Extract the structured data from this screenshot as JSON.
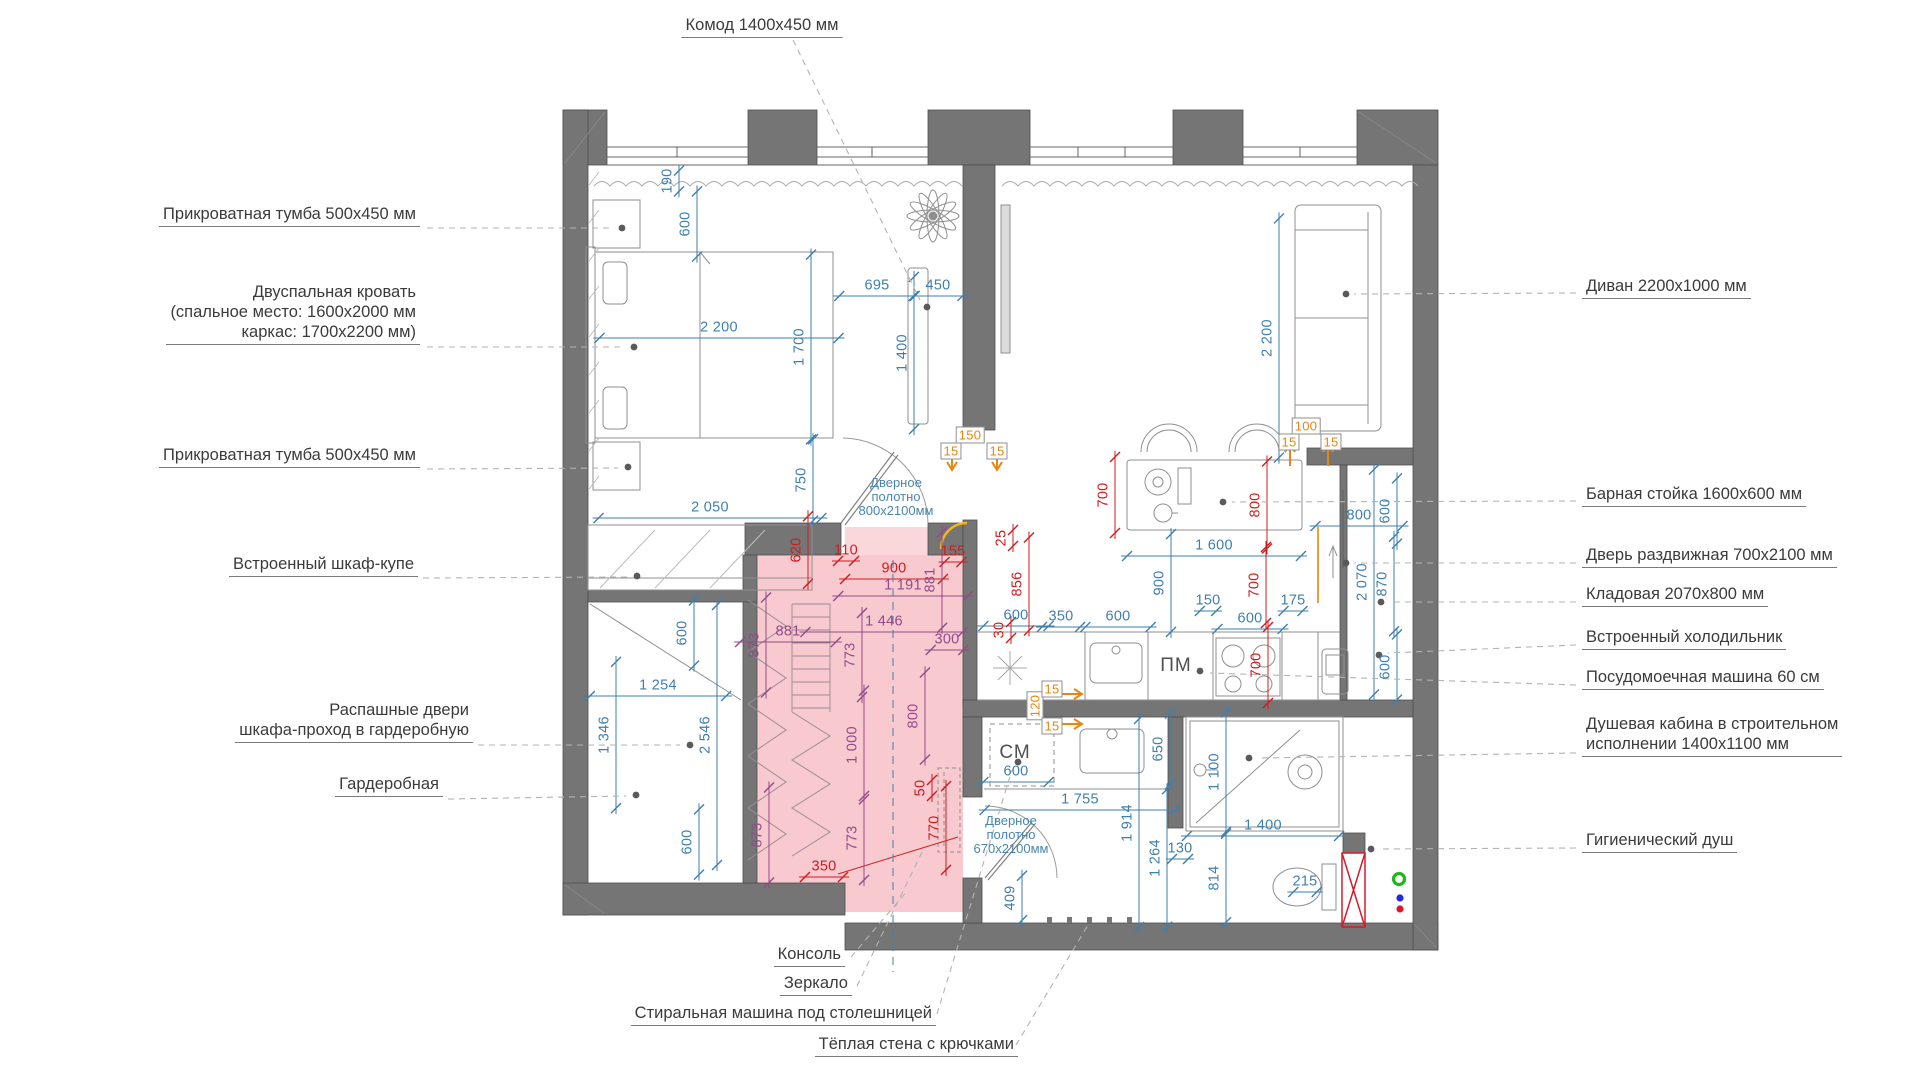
{
  "canvas": {
    "w": 1919,
    "h": 1079
  },
  "colors": {
    "wall": "#757575",
    "wall_edge": "#4e4e4e",
    "dim_blue": "#3f7fae",
    "dim_red": "#cf1d1d",
    "dim_purple": "#924a8a",
    "dim_orange": "#e8860d",
    "pink_zone": "#f8c9cf",
    "leader": "#b3b3b3",
    "furniture": "#8f8f8f",
    "accent_yellow": "#f3b51e",
    "marker_green": "#1db81d",
    "marker_blue": "#2525dd",
    "marker_red": "#e0152d"
  },
  "callouts": [
    {
      "name": "komod",
      "side": "top",
      "x": 762,
      "y": 26,
      "lines": [
        "Комод 1400х450 мм"
      ]
    },
    {
      "name": "nightstand-1",
      "side": "left",
      "x": 420,
      "y": 215,
      "lines": [
        "Прикроватная тумба  500х450 мм"
      ]
    },
    {
      "name": "bed",
      "side": "left",
      "x": 420,
      "y": 313,
      "lines": [
        "Двуспальная кровать",
        "(спальное место: 1600х2000 мм",
        "каркас: 1700х2200 мм)"
      ]
    },
    {
      "name": "nightstand-2",
      "side": "left",
      "x": 420,
      "y": 456,
      "lines": [
        "Прикроватная тумба  500х450 мм"
      ]
    },
    {
      "name": "built-in-wardrobe",
      "side": "left",
      "x": 418,
      "y": 565,
      "lines": [
        "Встроенный шкаф-купе"
      ]
    },
    {
      "name": "swing-doors",
      "side": "left",
      "x": 473,
      "y": 721,
      "lines": [
        "Распашные двери",
        "шкафа-проход в гардеробную"
      ]
    },
    {
      "name": "garderobnaya",
      "side": "left",
      "x": 443,
      "y": 785,
      "lines": [
        "Гардеробная"
      ]
    },
    {
      "name": "sofa",
      "side": "right",
      "x": 1582,
      "y": 287,
      "lines": [
        "Диван 2200х1000 мм"
      ]
    },
    {
      "name": "bar-counter",
      "side": "right",
      "x": 1582,
      "y": 495,
      "lines": [
        "Барная стойка 1600х600 мм"
      ]
    },
    {
      "name": "sliding-door",
      "side": "right",
      "x": 1582,
      "y": 556,
      "lines": [
        "Дверь раздвижная 700х2100 мм"
      ]
    },
    {
      "name": "kladovaya",
      "side": "right",
      "x": 1582,
      "y": 595,
      "lines": [
        "Кладовая 2070х800 мм"
      ]
    },
    {
      "name": "fridge",
      "side": "right",
      "x": 1582,
      "y": 638,
      "lines": [
        "Встроенный холодильник"
      ]
    },
    {
      "name": "dishwasher",
      "side": "right",
      "x": 1582,
      "y": 678,
      "lines": [
        "Посудомоечная машина 60 см"
      ]
    },
    {
      "name": "shower-cabin",
      "side": "right",
      "x": 1582,
      "y": 735,
      "lines": [
        "Душевая кабина в строительном",
        "исполнении 1400х1100 мм"
      ]
    },
    {
      "name": "hygienic-shower",
      "side": "right",
      "x": 1582,
      "y": 841,
      "lines": [
        "Гигиенический душ"
      ]
    },
    {
      "name": "console",
      "side": "bottom",
      "x": 845,
      "y": 955,
      "lines": [
        "Консоль"
      ]
    },
    {
      "name": "mirror",
      "side": "bottom",
      "x": 852,
      "y": 984,
      "lines": [
        "Зеркало"
      ]
    },
    {
      "name": "washing-machine",
      "side": "bottom",
      "x": 936,
      "y": 1014,
      "lines": [
        "Стиральная машина под столешницей"
      ]
    },
    {
      "name": "warm-wall",
      "side": "bottom",
      "x": 1018,
      "y": 1045,
      "lines": [
        "Тёплая стена с крючками"
      ]
    }
  ],
  "door_notes": [
    {
      "name": "door-leaf-800",
      "x": 896,
      "y": 476,
      "lines": [
        "Дверное",
        "полотно",
        "800х2100мм"
      ]
    },
    {
      "name": "door-leaf-670",
      "x": 1011,
      "y": 814,
      "lines": [
        "Дверное",
        "полотно",
        "670х2100мм"
      ]
    }
  ],
  "room_codes": [
    {
      "name": "dishwasher-code",
      "text": "ПМ",
      "x": 1176,
      "y": 666
    },
    {
      "name": "washer-code",
      "text": "СМ",
      "x": 1015,
      "y": 753
    }
  ],
  "dimensions": [
    {
      "t": "190",
      "x": 668,
      "y": 181,
      "r": 1,
      "c": "b"
    },
    {
      "t": "600",
      "x": 686,
      "y": 224,
      "r": 1,
      "c": "b"
    },
    {
      "t": "2 200",
      "x": 719,
      "y": 328,
      "c": "b"
    },
    {
      "t": "1 700",
      "x": 800,
      "y": 347,
      "r": 1,
      "c": "b"
    },
    {
      "t": "695",
      "x": 877,
      "y": 286,
      "c": "b"
    },
    {
      "t": "450",
      "x": 938,
      "y": 286,
      "c": "b"
    },
    {
      "t": "1 400",
      "x": 903,
      "y": 353,
      "r": 1,
      "c": "b"
    },
    {
      "t": "2 200",
      "x": 1268,
      "y": 338,
      "r": 1,
      "c": "b"
    },
    {
      "t": "2 050",
      "x": 710,
      "y": 508,
      "c": "b"
    },
    {
      "t": "750",
      "x": 802,
      "y": 480,
      "r": 1,
      "c": "b"
    },
    {
      "t": "600",
      "x": 683,
      "y": 633,
      "r": 1,
      "c": "b"
    },
    {
      "t": "1 254",
      "x": 658,
      "y": 686,
      "c": "b"
    },
    {
      "t": "1 346",
      "x": 605,
      "y": 735,
      "r": 1,
      "c": "b"
    },
    {
      "t": "2 546",
      "x": 706,
      "y": 735,
      "r": 1,
      "c": "b"
    },
    {
      "t": "600",
      "x": 688,
      "y": 842,
      "r": 1,
      "c": "b"
    },
    {
      "t": "600",
      "x": 1016,
      "y": 616,
      "c": "b"
    },
    {
      "t": "350",
      "x": 1061,
      "y": 617,
      "c": "b"
    },
    {
      "t": "600",
      "x": 1118,
      "y": 617,
      "c": "b"
    },
    {
      "t": "900",
      "x": 1160,
      "y": 583,
      "r": 1,
      "c": "b"
    },
    {
      "t": "150",
      "x": 1208,
      "y": 601,
      "c": "b"
    },
    {
      "t": "600",
      "x": 1250,
      "y": 619,
      "c": "b"
    },
    {
      "t": "175",
      "x": 1293,
      "y": 601,
      "c": "b"
    },
    {
      "t": "1 600",
      "x": 1214,
      "y": 546,
      "c": "b"
    },
    {
      "t": "800",
      "x": 1359,
      "y": 516,
      "c": "b"
    },
    {
      "t": "600",
      "x": 1386,
      "y": 511,
      "r": 1,
      "c": "b"
    },
    {
      "t": "2 070",
      "x": 1363,
      "y": 582,
      "r": 1,
      "c": "b"
    },
    {
      "t": "870",
      "x": 1383,
      "y": 584,
      "r": 1,
      "c": "b"
    },
    {
      "t": "600",
      "x": 1386,
      "y": 667,
      "r": 1,
      "c": "b"
    },
    {
      "t": "650",
      "x": 1159,
      "y": 749,
      "r": 1,
      "c": "b"
    },
    {
      "t": "1 914",
      "x": 1128,
      "y": 823,
      "r": 1,
      "c": "b"
    },
    {
      "t": "1 264",
      "x": 1156,
      "y": 858,
      "r": 1,
      "c": "b"
    },
    {
      "t": "130",
      "x": 1180,
      "y": 849,
      "c": "b"
    },
    {
      "t": "1 100",
      "x": 1215,
      "y": 772,
      "r": 1,
      "c": "b"
    },
    {
      "t": "1 400",
      "x": 1263,
      "y": 826,
      "c": "b"
    },
    {
      "t": "814",
      "x": 1215,
      "y": 878,
      "r": 1,
      "c": "b"
    },
    {
      "t": "409",
      "x": 1011,
      "y": 898,
      "r": 1,
      "c": "b"
    },
    {
      "t": "600",
      "x": 1016,
      "y": 772,
      "c": "b"
    },
    {
      "t": "1 755",
      "x": 1080,
      "y": 800,
      "c": "b"
    },
    {
      "t": "215",
      "x": 1305,
      "y": 882,
      "c": "b"
    },
    {
      "t": "620",
      "x": 797,
      "y": 550,
      "r": 1,
      "c": "r"
    },
    {
      "t": "110",
      "x": 846,
      "y": 551,
      "c": "r"
    },
    {
      "t": "900",
      "x": 894,
      "y": 569,
      "c": "r"
    },
    {
      "t": "155",
      "x": 953,
      "y": 552,
      "c": "r"
    },
    {
      "t": "25",
      "x": 1002,
      "y": 538,
      "r": 1,
      "c": "r"
    },
    {
      "t": "856",
      "x": 1018,
      "y": 584,
      "r": 1,
      "c": "r"
    },
    {
      "t": "30",
      "x": 1000,
      "y": 630,
      "r": 1,
      "c": "r"
    },
    {
      "t": "700",
      "x": 1104,
      "y": 495,
      "r": 1,
      "c": "r"
    },
    {
      "t": "800",
      "x": 1256,
      "y": 505,
      "r": 1,
      "c": "r"
    },
    {
      "t": "700",
      "x": 1255,
      "y": 585,
      "r": 1,
      "c": "r"
    },
    {
      "t": "700",
      "x": 1257,
      "y": 665,
      "r": 1,
      "c": "r"
    },
    {
      "t": "350",
      "x": 824,
      "y": 867,
      "c": "r"
    },
    {
      "t": "50",
      "x": 921,
      "y": 788,
      "r": 1,
      "c": "r"
    },
    {
      "t": "770",
      "x": 935,
      "y": 828,
      "r": 1,
      "c": "r"
    },
    {
      "t": "1 191",
      "x": 903,
      "y": 586,
      "c": "p"
    },
    {
      "t": "881",
      "x": 931,
      "y": 580,
      "r": 1,
      "c": "p"
    },
    {
      "t": "1 446",
      "x": 884,
      "y": 622,
      "c": "p"
    },
    {
      "t": "300",
      "x": 947,
      "y": 640,
      "c": "p"
    },
    {
      "t": "773",
      "x": 851,
      "y": 655,
      "r": 1,
      "c": "p"
    },
    {
      "t": "881",
      "x": 788,
      "y": 632,
      "c": "p"
    },
    {
      "t": "873",
      "x": 755,
      "y": 645,
      "r": 1,
      "c": "p"
    },
    {
      "t": "873",
      "x": 758,
      "y": 835,
      "r": 1,
      "c": "p"
    },
    {
      "t": "773",
      "x": 853,
      "y": 838,
      "r": 1,
      "c": "p"
    },
    {
      "t": "800",
      "x": 914,
      "y": 716,
      "r": 1,
      "c": "p"
    },
    {
      "t": "1 000",
      "x": 853,
      "y": 745,
      "r": 1,
      "c": "p"
    },
    {
      "t": "150",
      "x": 970,
      "y": 435,
      "c": "o"
    },
    {
      "t": "15",
      "x": 951,
      "y": 451,
      "c": "o"
    },
    {
      "t": "15",
      "x": 997,
      "y": 451,
      "c": "o"
    },
    {
      "t": "100",
      "x": 1306,
      "y": 426,
      "c": "o"
    },
    {
      "t": "15",
      "x": 1289,
      "y": 442,
      "c": "o"
    },
    {
      "t": "15",
      "x": 1331,
      "y": 442,
      "c": "o"
    },
    {
      "t": "120",
      "x": 1035,
      "y": 706,
      "r": 1,
      "c": "o"
    },
    {
      "t": "15",
      "x": 1052,
      "y": 689,
      "c": "o"
    },
    {
      "t": "15",
      "x": 1052,
      "y": 726,
      "c": "o"
    }
  ],
  "legend_dots": [
    {
      "name": "marker-green",
      "color": "#1db81d",
      "x": 1399,
      "y": 879,
      "ring": true
    },
    {
      "name": "marker-blue",
      "color": "#2525dd",
      "x": 1400,
      "y": 898
    },
    {
      "name": "marker-red",
      "color": "#e0152d",
      "x": 1400,
      "y": 909
    }
  ]
}
